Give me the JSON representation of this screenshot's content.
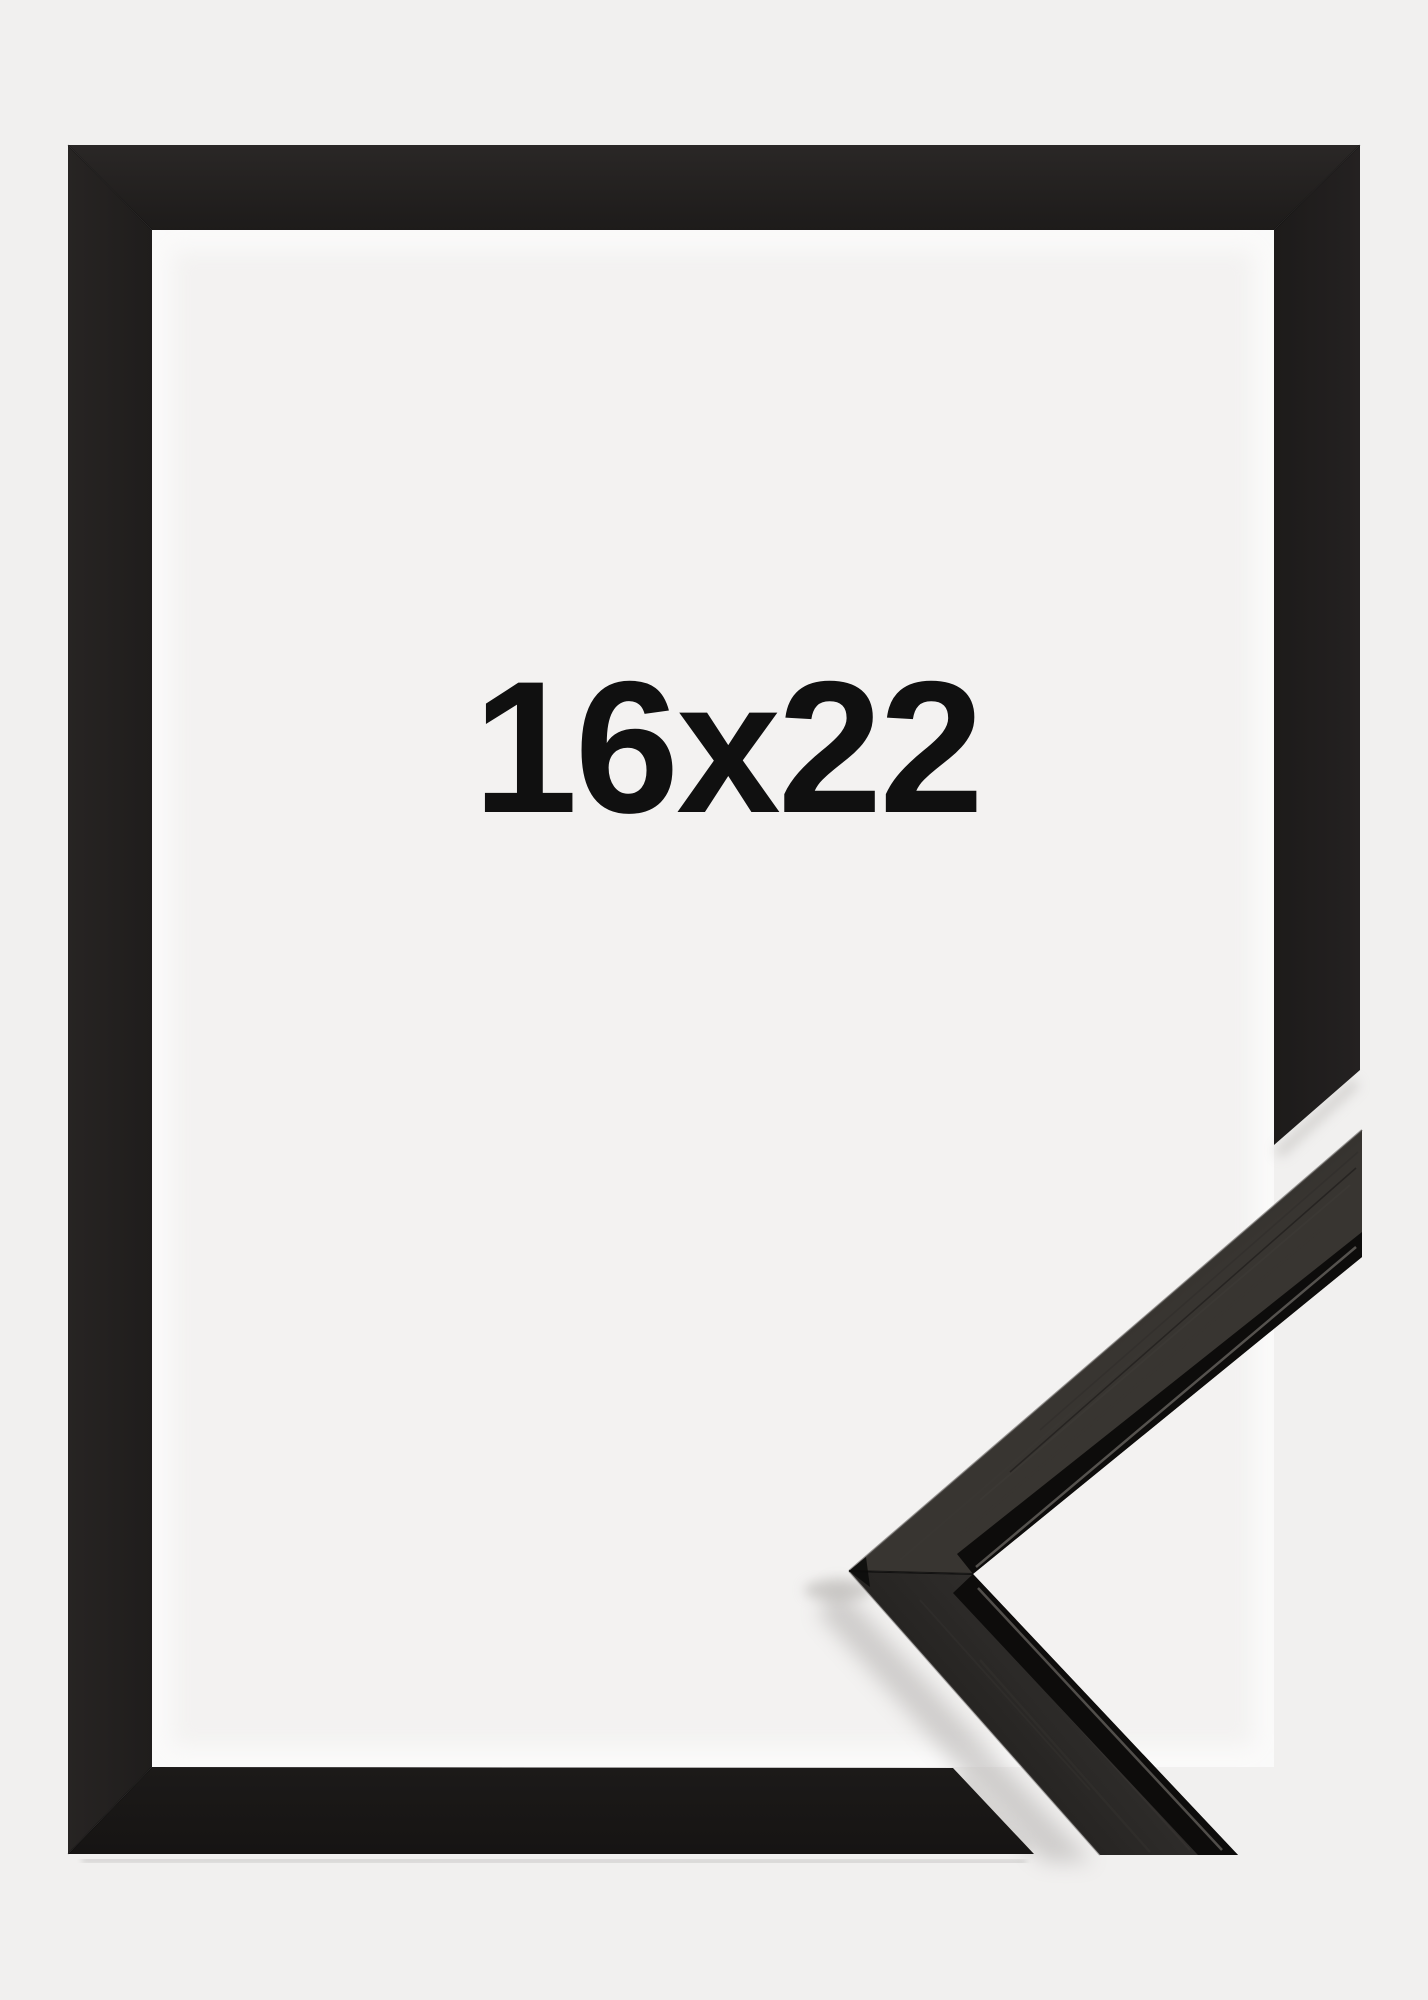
{
  "product": {
    "size_label": "16x22",
    "frame_style": "black-wood-frame-with-corner-sample"
  },
  "colors": {
    "background": "#f1f0ef",
    "mat_interior": "#f3f2f1",
    "mat_glow": "#ffffff",
    "frame_base": "#201d1c",
    "sample_face_upper": "#32302d",
    "sample_face_lower": "#2c2a28",
    "sample_edge": "#0d0c0b",
    "sample_highlight": "#5d5a56",
    "label_text": "#101010"
  }
}
